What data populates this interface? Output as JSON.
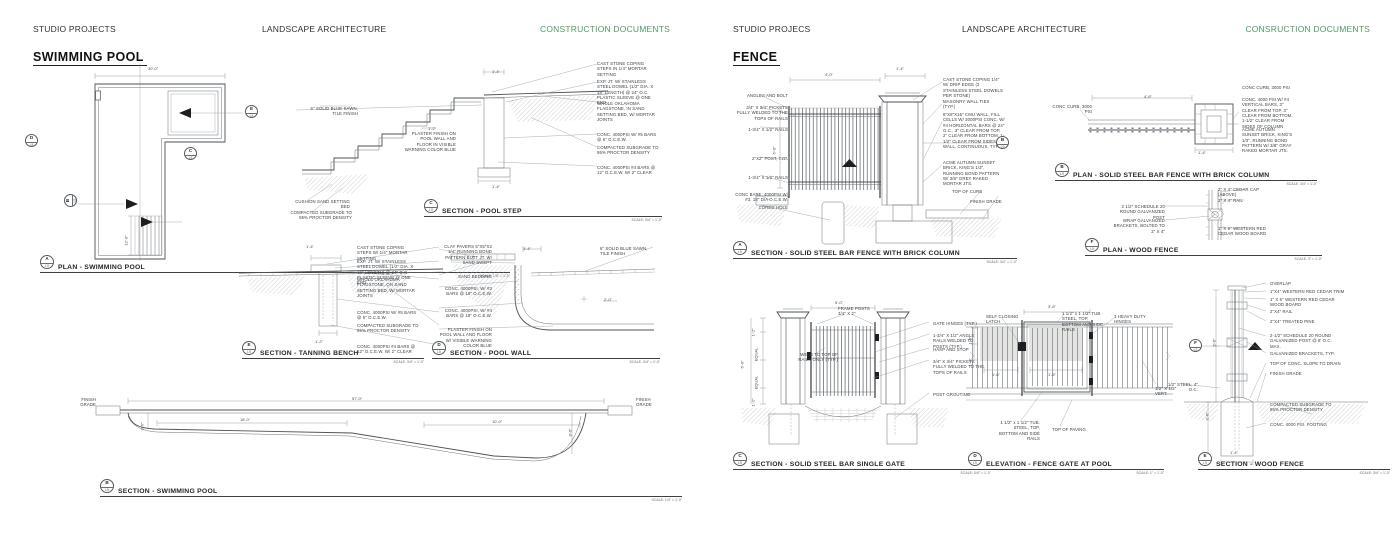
{
  "colors": {
    "accent_green": "#4f9c63",
    "line": "#5c6165",
    "text": "#2e3133"
  },
  "pool_page": {
    "header": {
      "left": "STUDIO PROJECTS",
      "center": "LANDSCAPE ARCHITECTURE",
      "right": "CONSTRUCTION DOCUMENTS"
    },
    "title": "SWIMMING POOL",
    "plan": {
      "ref": "A",
      "sheet": "L5",
      "title": "PLAN - SWIMMING POOL",
      "scale": "SCALE: 1/8\" = 1'-0\"",
      "dim_width": "30'-0\"",
      "dim_steps": "12'-0\"",
      "markers": {
        "e": {
          "ref": "E",
          "sheet": "L5"
        },
        "d": {
          "ref": "D",
          "sheet": "L5"
        },
        "c": {
          "ref": "C",
          "sheet": "L5"
        },
        "b": {
          "ref": "B",
          "sheet": "L5"
        }
      }
    },
    "step_section": {
      "ref": "C",
      "sheet": "L5",
      "title": "SECTION - POOL STEP",
      "scale": "SCALE: 3/4\" = 1'-0\"",
      "labels_left": [
        "6\" SOLID BLUE SAWN, TILE FINISH",
        "PLASTER FINISH ON POOL WALL AND FLOOR IN VISIBLE WARNING COLOR BLUE",
        "CUSHION SAND SETTING BED",
        "COMPACTED SUBGRADE TO 95% PROCTOR DENSITY"
      ],
      "labels_right": [
        "CAST STONE COPING STEPS IN 1/4\" MORTAR SETTING",
        "EXP. JT. W/ STAINLESS STEEL DOWEL (1/2\" DIA. X 18\" LENGTH) @ 24\" O.C. PLASTIC SLEEVE @ ONE END",
        "WHOLE OKLAHOMA FLAGSTONE, IN SAND SETTING BED, W/ MORTAR JOINTS",
        "CONC. 4000PSI W/ #5 BARS @ 6\" O.C.E.W.",
        "COMPACTED SUBGRADE TO 95% PROCTOR DENSITY",
        "CONC. 4000PSI #4 BARS @ 12\" O.C.E.W. W/ 2\" CLEAR"
      ],
      "dims": {
        "top": "1'-4\"",
        "mid": "1'-2\"",
        "bottom": "1'-4\""
      }
    },
    "bench_section": {
      "ref": "E",
      "sheet": "L5",
      "title": "SECTION - TANNING BENCH",
      "scale": "SCALE: 3/4\" = 1'-0\"",
      "labels_right": [
        "CAST STONE COPING STEPS W/ 1/4\" MORTAR SETTING",
        "EXP. JT. W/ STAINLESS STEEL DOWEL (1/2\" DIA. X 18\" LENGTH) @ 24\" O.C. PLASTIC SLEEVE @ ONE END",
        "WHOLE OKLAHOMA FLAGSTONE, ON SAND SETTING BED, W/ MORTAR JOINTS",
        "CONC. 4000PSI W/ #5 BARS @ 6\" O.C.E.W.",
        "COMPACTED SUBGRADE TO 95% PROCTOR DENSITY",
        "CONC. 4000PSI #4 BARS @ 12\" O.C.E.W. W/ 2\" CLEAR"
      ],
      "dims": {
        "top": "1'-4\"",
        "base": "1'-2\""
      }
    },
    "wall_section": {
      "ref": "D",
      "sheet": "L5",
      "title": "SECTION - POOL WALL",
      "scale": "SCALE: 3/4\" = 1'-0\"",
      "labels_left": [
        "CLAY PAVERS 5\"X5\"X2 1/4\" RUNNING BOND PATTERN BUTT JT. W/ SAND SWEPT",
        "SAND BEDDING",
        "CONC. 4000PSI, W/ #3 BARS @ 18\" O.C.E.W.",
        "CONC. 4000PSI, W/ #4 BARS @ 18\" O.C.E.W.",
        "PLASTER FINISH ON POOL WALL AND FLOOR W/ VISIBLE WARNING COLOR BLUE"
      ],
      "labels_right": [
        "6\" SOLID BLUE SAWN, TILE FINISH"
      ],
      "dims": {
        "top": "1'-4\"",
        "right": "2'-0\""
      }
    },
    "pool_section": {
      "ref": "B",
      "sheet": "L5",
      "title": "SECTION - SWIMMING POOL",
      "scale": "SCALE: 1/4\" = 1'-0\"",
      "grade_left": "FINISH GRADE",
      "grade_right": "FINISH GRADE",
      "dims": {
        "total": "57'-0\"",
        "shallow": "18'-0\"",
        "deep": "10'-0\"",
        "depth_left": "3'-6\"",
        "depth_right": "8'-0\""
      }
    }
  },
  "fence_page": {
    "header": {
      "left": "STUDIO PROJECS",
      "center": "LANDSCAPE ARCHITECTURE",
      "right": "CONSRUCTION DOCUMENTS"
    },
    "title": "FENCE",
    "bar_section": {
      "ref": "A",
      "sheet": "L9",
      "title": "SECTION - SOLID STEEL BAR FENCE WITH BRICK COLUMN",
      "scale": "SCALE: 3/4\" = 1'-0\"",
      "labels_left": [
        "ANGLES AND BOLT",
        "3/4\" X 3/4\" PICKETS FULLY WELDED TO THE TOPS OF RAILS",
        "1-3/4\" X 1/2\" RAILS",
        "2\"X2\" POST, TYP.",
        "1-3/4\" X 1/2\" RAILS",
        "CONC BASE: 4000PSI W/ #3, 18\" DIA O.C.E.W.",
        "CORED HOLE"
      ],
      "labels_right": [
        "CAST STONE COPING 1/4\" W/ DRIP EDGE (2 STAINLESS STEEL DOWELS PER STONE)",
        "MASONRY WALL TIES (TYP.)",
        "8\"X8\"X16\" CMU WALL, FILL CELLS W/ 3000PSI CONC. W/ #4 HORIZONTAL BARS @ 24\" O.C., 3\" CLEAR FROM TOP, 2\" CLEAR FROM BOTTOM, 1-1/2\" CLEAR FROM SIDES OF WALL, CONTINUOUS, TYP.",
        "ACME AUTUMN SUNSET BRICK, KING'S 1/3\", RUNNING BOND PATTERN W/ 3/8\" GREY RAKED MORTAR JTS.",
        "TOP OF CURB",
        "FINISH GRADE"
      ],
      "dims": {
        "width": "4'-0\"",
        "cap": "1'-4\"",
        "height": "6'-0\""
      },
      "marker": {
        "ref": "B",
        "sheet": "L9"
      }
    },
    "bar_plan": {
      "ref": "B",
      "sheet": "L9",
      "title": "PLAN - SOLID STEEL BAR FENCE WITH BRICK COLUMN",
      "scale": "SCALE: 3/4\" = 1'-0\"",
      "label_curb": "CONC CURB, 3000 PSI",
      "labels_right": [
        "CONC CURB, 3000 PSI",
        "CONC. 4000 PSI W/ #4 VERTICAL BARS, 3\" CLEAR FROM TOP, 3\" CLEAR FROM BOTTOM, 1-1/2\" CLEAR FROM SIDES OF COLUMN",
        "ACME AUTUMN SUNSET BRICK, KING'S 1/3\", RUNNING BOND PATTERN W/ 3/8\" GRAY RAKED MORTAR JTS."
      ],
      "dims": {
        "run": "4'-6\"",
        "column": "1'-4\""
      }
    },
    "wood_plan": {
      "ref": "F",
      "sheet": "L9",
      "title": "PLAN - WOOD FENCE",
      "scale": "SCALE: 3\" = 1'-0\"",
      "labels_left": [
        "2 1/2\" SCHEDULE 20 ROUND GALVANIZED POST",
        "WRAP GALVANIZED BRACKETS, BOLTED TO 2\" X 4\""
      ],
      "labels_right": [
        "2\" X 4\" CEDAR CAP (ABOVE)",
        "2\" X 4\" RAIL",
        "1\" X 6\" WESTERN RED CEDAR WOOD BOARD"
      ]
    },
    "gate_section": {
      "ref": "C",
      "sheet": "L9",
      "title": "SECTION - SOLID STEEL BAR SINGLE GATE",
      "scale": "SCALE: 3/4\" = 1'-0\"",
      "label_frame": "FRAME POSTS 3/4\" X 2\"",
      "label_weld": "WELD TO TOP OF RAILS ONLY (TYP.)",
      "labels_right": [
        "GATE HINGES (TYP.)",
        "1-3/4\" X 1/2\" ANGLE RAILS WELDED TO POSTS (TYP.)",
        "HASP AND STOP",
        "3/4\" X 3/4\" PICKETS FULLY WELDED TO THE TOPS OF RAILS",
        "POST GROUTING"
      ],
      "dims": {
        "top": "5'-0\"",
        "side_top": "1'-2\"",
        "eq1": "EQUAL",
        "eq2": "EQUAL",
        "side_bot": "1'-2\"",
        "height": "6'-0\""
      }
    },
    "gate_elevation": {
      "ref": "D",
      "sheet": "L9",
      "title": "ELEVATION - FENCE GATE AT POOL",
      "scale": "SCALE: 1\" = 1'-0\"",
      "labels": {
        "latch": "SELF CLOSING LATCH",
        "rails_top": "1 1/2\" x 1 1/2\" TUB. STEEL, TOP, BOTTOM AND SIDE RAILS",
        "hinges": "3 HEAVY DUTY HINGES",
        "rails_bottom": "1 1/2\" x 1 1/2\" TUB. STEEL, TOP, BOTTOM AND SIDE RAILS",
        "paving": "TOP OF PAVING",
        "vert": "1/2\" X 1/2\" VERT."
      },
      "dims": {
        "top": "3'-6\"",
        "left_a": "1'-6\"",
        "left_b": "1'-2\"",
        "bot_a": "1'-6\"",
        "bot_b": "1'-6\""
      }
    },
    "wood_section": {
      "ref": "E",
      "sheet": "L9",
      "title": "SECTION - WOOD FENCE",
      "scale": "SCALE: 3/4\" = 1'-0\"",
      "label_left": "1/2\" STEEL, 4\" O.C.",
      "labels_right": [
        "OVERLAP",
        "1\"X4\" WESTERN RED CEDAR TRIM",
        "1\" X 6\" WESTERN RED CEDAR WOOD BOARD",
        "2\"X4\" RAIL",
        "2\"X4\" TREATED PINE",
        "2-1/2\" SCHEDULE 20 ROUND GALVANIZED POST @ 8' O.C. MAX.",
        "GALVANIZED BRACKETS, TYP.",
        "TOP OF CONC. SLOPE TO DRAIN",
        "FINISH GRADE",
        "COMPACTED SUBGRADE TO 95% PROCTOR DENSITY",
        "CONC. 4000 PSI. FOOTING"
      ],
      "dims": {
        "height": "5'-6\"",
        "depth": "2'-6\"",
        "base": "1'-4\""
      },
      "marker": {
        "ref": "F",
        "sheet": "L9"
      }
    }
  }
}
